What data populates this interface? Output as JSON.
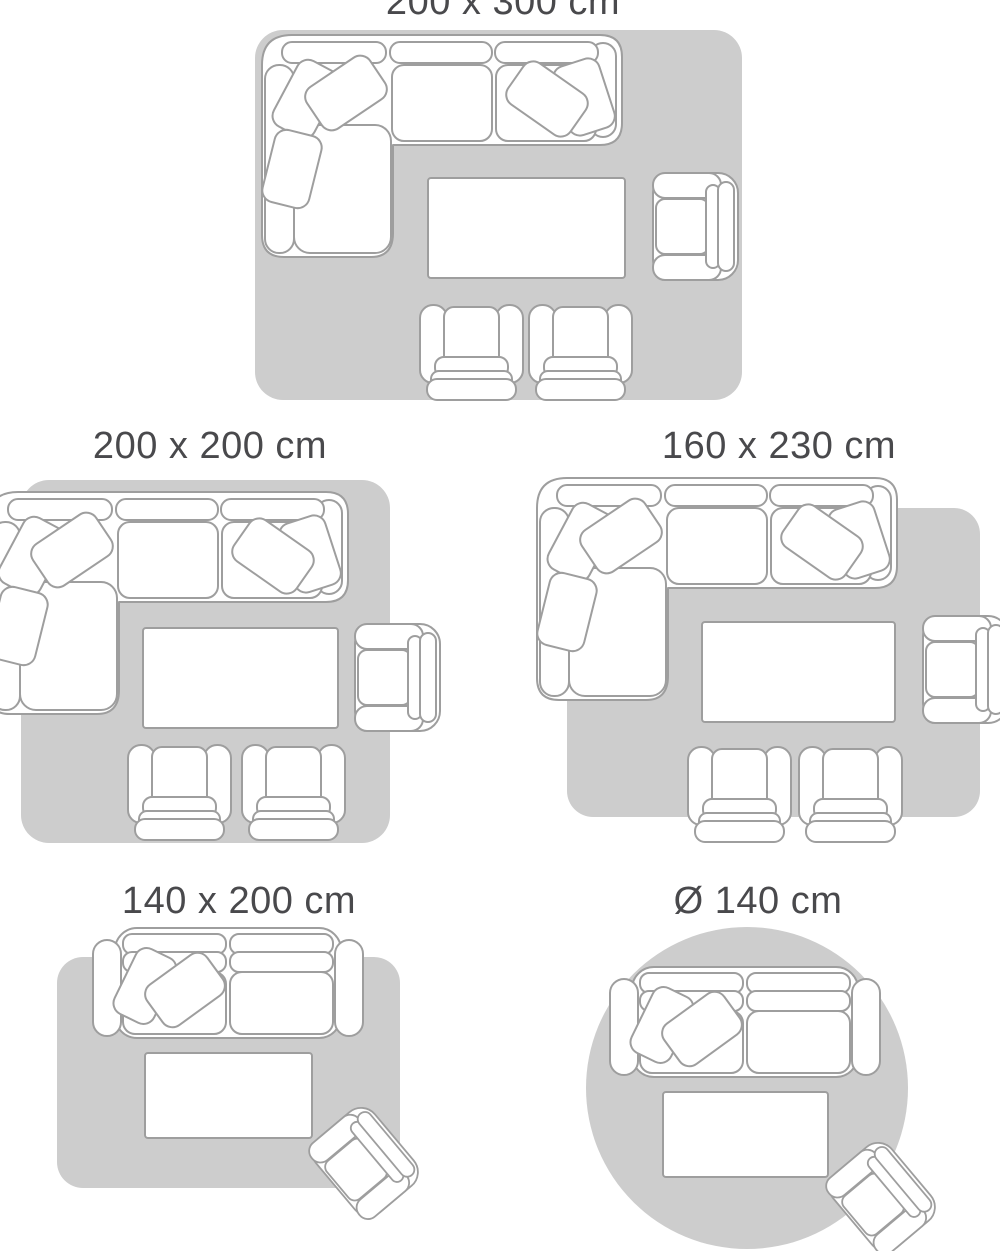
{
  "colors": {
    "background": "#ffffff",
    "rug": "#cdcdcd",
    "furniture_fill": "#ffffff",
    "outline": "#9e9e9e",
    "label": "#49494c"
  },
  "guide": {
    "description": "rug size guide with furniture arrangement diagrams",
    "panels": [
      {
        "id": "size-200x300",
        "label": "200 x 300 cm",
        "rug_shape": "rectangle",
        "furniture": [
          "corner-sofa",
          "coffee-table",
          "armchair",
          "lounge-chair",
          "lounge-chair"
        ]
      },
      {
        "id": "size-200x200",
        "label": "200 x 200 cm",
        "rug_shape": "rectangle",
        "furniture": [
          "corner-sofa",
          "coffee-table",
          "armchair",
          "lounge-chair",
          "lounge-chair"
        ]
      },
      {
        "id": "size-160x230",
        "label": "160 x 230 cm",
        "rug_shape": "rectangle",
        "furniture": [
          "corner-sofa",
          "coffee-table",
          "armchair",
          "lounge-chair",
          "lounge-chair"
        ]
      },
      {
        "id": "size-140x200",
        "label": "140 x 200 cm",
        "rug_shape": "rectangle",
        "furniture": [
          "sofa",
          "coffee-table",
          "tilted-armchair"
        ]
      },
      {
        "id": "size-round-140",
        "label": "Ø 140 cm",
        "rug_shape": "circle",
        "furniture": [
          "sofa",
          "coffee-table",
          "tilted-armchair"
        ]
      }
    ]
  }
}
